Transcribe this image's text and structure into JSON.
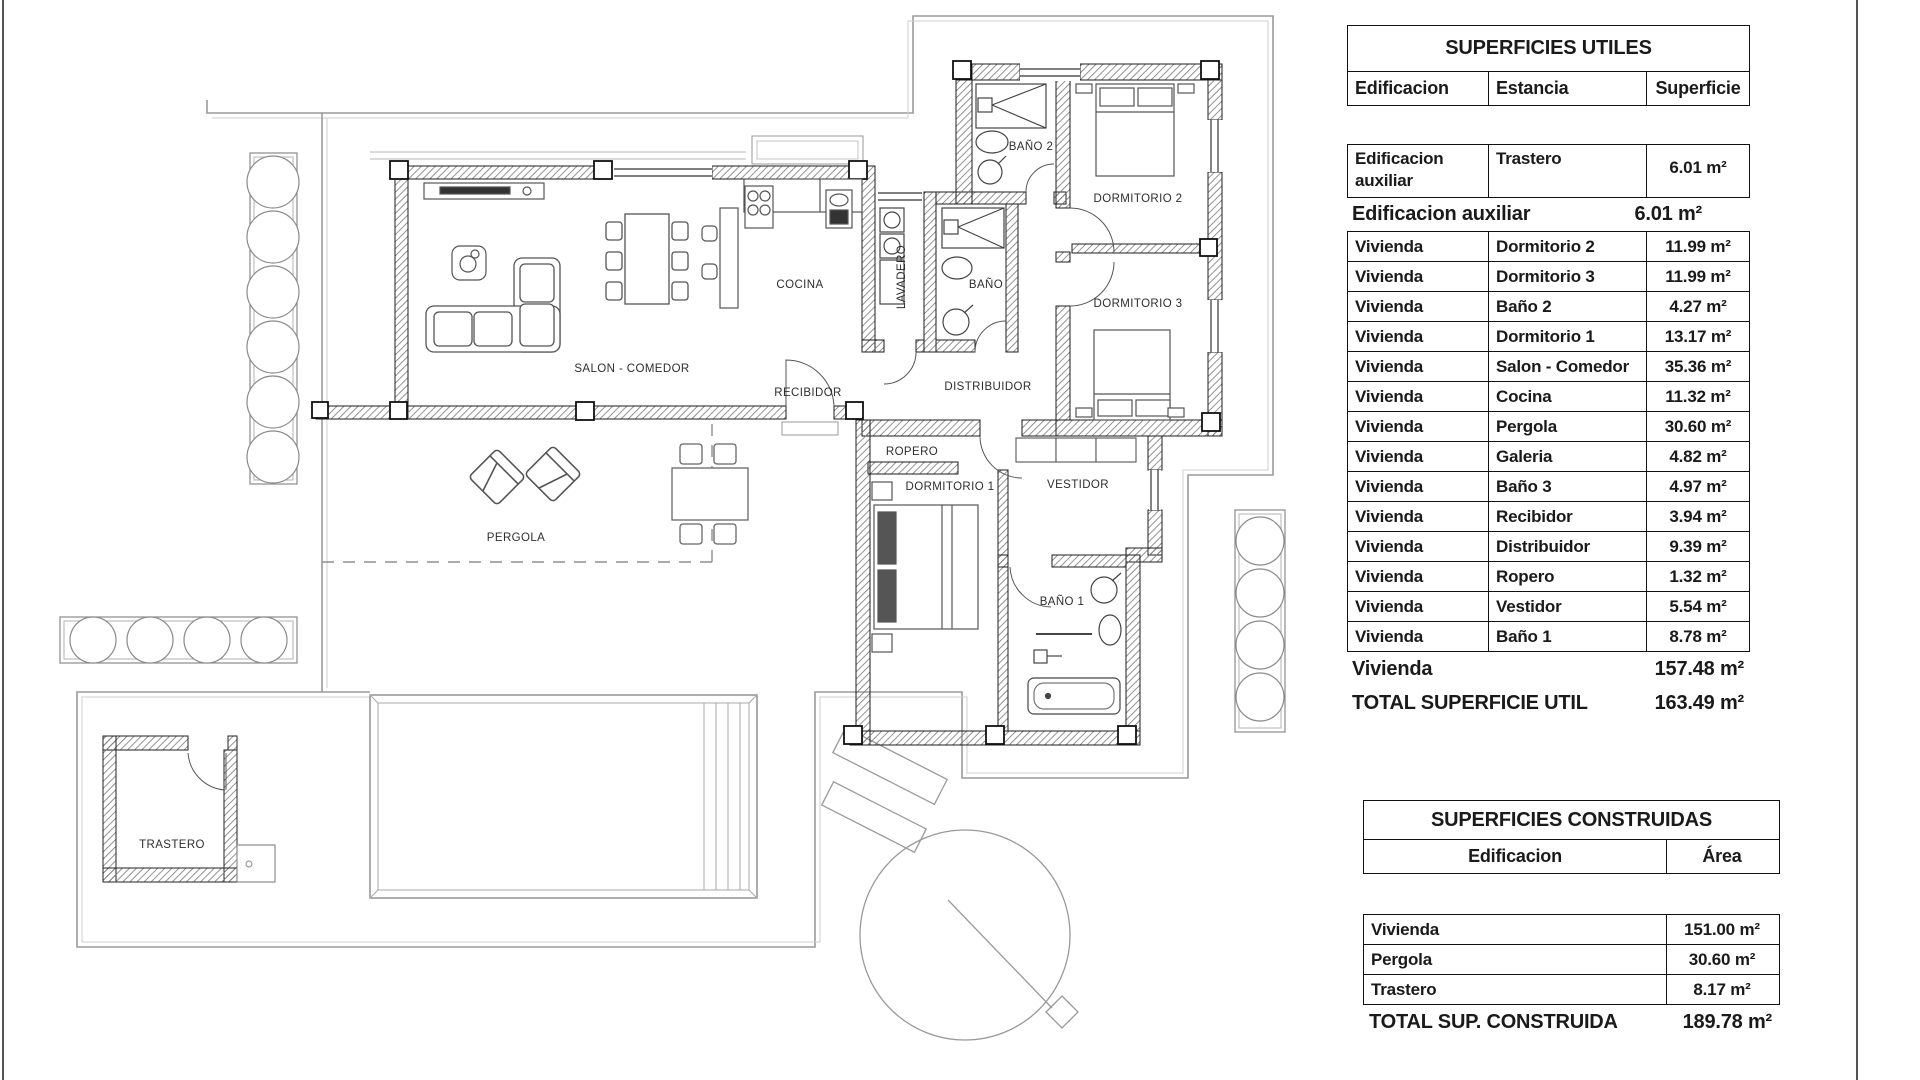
{
  "plan": {
    "labels": [
      {
        "id": "salon",
        "text": "SALON - COMEDOR"
      },
      {
        "id": "cocina",
        "text": "COCINA"
      },
      {
        "id": "lavadero",
        "text": "LAVADERO"
      },
      {
        "id": "bano",
        "text": "BAÑO"
      },
      {
        "id": "bano2",
        "text": "BAÑO 2"
      },
      {
        "id": "dormitorio2",
        "text": "DORMITORIO 2"
      },
      {
        "id": "dormitorio3",
        "text": "DORMITORIO 3"
      },
      {
        "id": "recibidor",
        "text": "RECIBIDOR"
      },
      {
        "id": "distribuidor",
        "text": "DISTRIBUIDOR"
      },
      {
        "id": "ropero",
        "text": "ROPERO"
      },
      {
        "id": "dormitorio1",
        "text": "DORMITORIO 1"
      },
      {
        "id": "vestidor",
        "text": "VESTIDOR"
      },
      {
        "id": "bano1",
        "text": "BAÑO 1"
      },
      {
        "id": "pergola",
        "text": "PERGOLA"
      },
      {
        "id": "trastero",
        "text": "TRASTERO"
      }
    ]
  },
  "tables": {
    "utiles": {
      "title": "SUPERFICIES UTILES",
      "columns": [
        "Edificacion",
        "Estancia",
        "Superficie"
      ],
      "aux_row": [
        "Edificacion auxiliar",
        "Trastero",
        "6.01 m²"
      ],
      "aux_subtotal": {
        "label": "Edificacion auxiliar",
        "value": "6.01 m²"
      },
      "rows": [
        [
          "Vivienda",
          "Dormitorio 2",
          "11.99 m²"
        ],
        [
          "Vivienda",
          "Dormitorio 3",
          "11.99 m²"
        ],
        [
          "Vivienda",
          "Baño 2",
          "4.27 m²"
        ],
        [
          "Vivienda",
          "Dormitorio 1",
          "13.17 m²"
        ],
        [
          "Vivienda",
          "Salon - Comedor",
          "35.36 m²"
        ],
        [
          "Vivienda",
          "Cocina",
          "11.32 m²"
        ],
        [
          "Vivienda",
          "Pergola",
          "30.60 m²"
        ],
        [
          "Vivienda",
          "Galeria",
          "4.82 m²"
        ],
        [
          "Vivienda",
          "Baño 3",
          "4.97 m²"
        ],
        [
          "Vivienda",
          "Recibidor",
          "3.94 m²"
        ],
        [
          "Vivienda",
          "Distribuidor",
          "9.39 m²"
        ],
        [
          "Vivienda",
          "Ropero",
          "1.32 m²"
        ],
        [
          "Vivienda",
          "Vestidor",
          "5.54 m²"
        ],
        [
          "Vivienda",
          "Baño 1",
          "8.78 m²"
        ]
      ],
      "vivienda_subtotal": {
        "label": "Vivienda",
        "value": "157.48 m²"
      },
      "total": {
        "label": "TOTAL SUPERFICIE UTIL",
        "value": "163.49 m²"
      }
    },
    "construidas": {
      "title": "SUPERFICIES CONSTRUIDAS",
      "columns": [
        "Edificacion",
        "Área"
      ],
      "rows": [
        [
          "Vivienda",
          "151.00 m²"
        ],
        [
          "Pergola",
          "30.60 m²"
        ],
        [
          "Trastero",
          "8.17 m²"
        ]
      ],
      "total": {
        "label": "TOTAL SUP. CONSTRUIDA",
        "value": "189.78 m²"
      }
    }
  },
  "colors": {
    "paper": "#ffffff",
    "ink": "#1a1a1a",
    "wall_hatch": "#777777",
    "boundary": "#9a9a9a"
  }
}
